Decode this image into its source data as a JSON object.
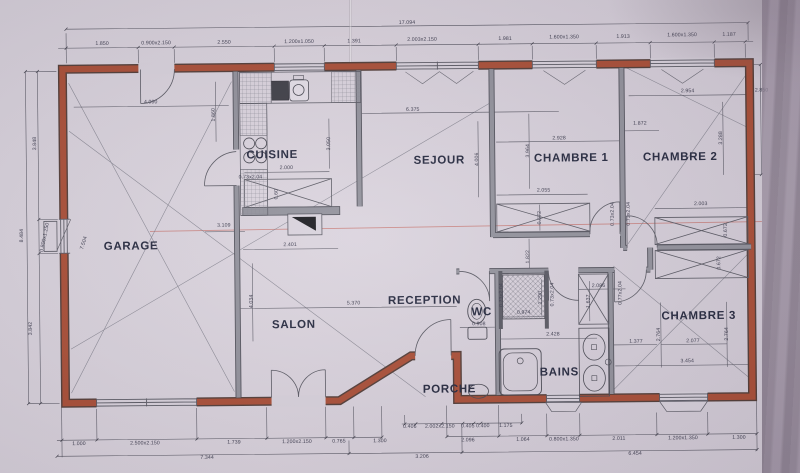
{
  "plan": {
    "overall_width_label": "17.094",
    "colors": {
      "paper": "#d8d2dc",
      "exterior_wall": "#a84a31",
      "wall_edge": "#4e3832",
      "interior_wall": "#8f8f99",
      "line": "#4c4c58",
      "label_text": "#20243a",
      "red_pen_line": "#c0554a"
    },
    "rooms": [
      {
        "label": "GARAGE",
        "x": 131,
        "y": 244
      },
      {
        "label": "CUISINE",
        "x": 273,
        "y": 154
      },
      {
        "label": "SEJOUR",
        "x": 440,
        "y": 161
      },
      {
        "label": "CHAMBRE 1",
        "x": 572,
        "y": 160
      },
      {
        "label": "CHAMBRE 2",
        "x": 681,
        "y": 160
      },
      {
        "label": "CHAMBRE 3",
        "x": 698,
        "y": 319
      },
      {
        "label": "SALON",
        "x": 293,
        "y": 324
      },
      {
        "label": "RECEPTION",
        "x": 424,
        "y": 301
      },
      {
        "label": "WC",
        "x": 481,
        "y": 313
      },
      {
        "label": "BAINS",
        "x": 558,
        "y": 374
      },
      {
        "label": "PORCHE",
        "x": 448,
        "y": 390
      }
    ],
    "dims": [
      {
        "text": "17.094",
        "x": 409,
        "y": 23,
        "rot": 0
      },
      {
        "text": "1.850",
        "x": 104,
        "y": 41,
        "rot": 0
      },
      {
        "text": "0.900x2.150",
        "x": 158,
        "y": 41,
        "rot": 0
      },
      {
        "text": "2.550",
        "x": 226,
        "y": 41,
        "rot": 0
      },
      {
        "text": "1.200x1.050",
        "x": 301,
        "y": 41,
        "rot": 0
      },
      {
        "text": "1.391",
        "x": 356,
        "y": 41,
        "rot": 0
      },
      {
        "text": "2.003x2.150",
        "x": 424,
        "y": 40,
        "rot": 0
      },
      {
        "text": "1.981",
        "x": 507,
        "y": 40,
        "rot": 0
      },
      {
        "text": "1.600x1.350",
        "x": 566,
        "y": 39,
        "rot": 0
      },
      {
        "text": "1.913",
        "x": 625,
        "y": 39,
        "rot": 0
      },
      {
        "text": "1.600x1.350",
        "x": 684,
        "y": 38,
        "rot": 0
      },
      {
        "text": "1.187",
        "x": 731,
        "y": 38,
        "rot": 0
      },
      {
        "text": "3.848",
        "x": 36,
        "y": 140,
        "rot": -90
      },
      {
        "text": "8.484",
        "x": 22,
        "y": 232,
        "rot": -90
      },
      {
        "text": "0.800x1.250",
        "x": 45,
        "y": 234,
        "rot": -78
      },
      {
        "text": "3.842",
        "x": 30,
        "y": 325,
        "rot": -90
      },
      {
        "text": "7.504",
        "x": 84,
        "y": 240,
        "rot": -72
      },
      {
        "text": "4.000",
        "x": 152,
        "y": 100,
        "rot": 0
      },
      {
        "text": "1.860",
        "x": 215,
        "y": 113,
        "rot": -90
      },
      {
        "text": "0.73x2.04",
        "x": 251,
        "y": 176,
        "rot": 0
      },
      {
        "text": "3.109",
        "x": 224,
        "y": 224,
        "rot": 0
      },
      {
        "text": "6.375",
        "x": 414,
        "y": 110,
        "rot": 0
      },
      {
        "text": "3.050",
        "x": 330,
        "y": 143,
        "rot": -90
      },
      {
        "text": "2.000",
        "x": 287,
        "y": 167,
        "rot": 0
      },
      {
        "text": "0.60",
        "x": 277,
        "y": 193,
        "rot": -90
      },
      {
        "text": "2.401",
        "x": 290,
        "y": 244,
        "rot": 0
      },
      {
        "text": "4.034",
        "x": 251,
        "y": 300,
        "rot": -90
      },
      {
        "text": "5.370",
        "x": 353,
        "y": 303,
        "rot": 0
      },
      {
        "text": "4.006",
        "x": 478,
        "y": 160,
        "rot": -90
      },
      {
        "text": "2.928",
        "x": 560,
        "y": 140,
        "rot": 0
      },
      {
        "text": "3.964",
        "x": 529,
        "y": 152,
        "rot": -90
      },
      {
        "text": "2.055",
        "x": 544,
        "y": 192,
        "rot": 0
      },
      {
        "text": "0.672",
        "x": 540,
        "y": 219,
        "rot": -90
      },
      {
        "text": "0.73x2.04",
        "x": 613,
        "y": 216,
        "rot": -90
      },
      {
        "text": "0.73x2.04",
        "x": 629,
        "y": 216,
        "rot": -90
      },
      {
        "text": "1.872",
        "x": 641,
        "y": 126,
        "rot": 0
      },
      {
        "text": "2.954",
        "x": 689,
        "y": 94,
        "rot": 0
      },
      {
        "text": "2.850",
        "x": 763,
        "y": 94,
        "rot": 0
      },
      {
        "text": "3.288",
        "x": 722,
        "y": 141,
        "rot": -90
      },
      {
        "text": "2.003",
        "x": 701,
        "y": 207,
        "rot": 0
      },
      {
        "text": "0.672",
        "x": 726,
        "y": 233,
        "rot": -90
      },
      {
        "text": "0.672",
        "x": 719,
        "y": 266,
        "rot": -90
      },
      {
        "text": "1.822",
        "x": 528,
        "y": 258,
        "rot": -90
      },
      {
        "text": "0.908",
        "x": 478,
        "y": 325,
        "rot": 0
      },
      {
        "text": "0.73x2.04",
        "x": 501,
        "y": 296,
        "rot": -90
      },
      {
        "text": "0.73x2.04",
        "x": 552,
        "y": 296,
        "rot": -90
      },
      {
        "text": "0.974",
        "x": 523,
        "y": 314,
        "rot": 0
      },
      {
        "text": "1.290",
        "x": 540,
        "y": 299,
        "rot": -90
      },
      {
        "text": "2.428",
        "x": 552,
        "y": 336,
        "rot": 0
      },
      {
        "text": "2.086",
        "x": 598,
        "y": 288,
        "rot": 0
      },
      {
        "text": "1.637",
        "x": 588,
        "y": 303,
        "rot": -90
      },
      {
        "text": "0.77x2.04",
        "x": 620,
        "y": 295,
        "rot": -90
      },
      {
        "text": "1.377",
        "x": 635,
        "y": 344,
        "rot": 0
      },
      {
        "text": "2.764",
        "x": 658,
        "y": 337,
        "rot": -90
      },
      {
        "text": "2.077",
        "x": 692,
        "y": 344,
        "rot": 0
      },
      {
        "text": "2.764",
        "x": 726,
        "y": 337,
        "rot": -90
      },
      {
        "text": "3.454",
        "x": 686,
        "y": 364,
        "rot": 0
      },
      {
        "text": "1.000",
        "x": 77,
        "y": 441,
        "rot": 0
      },
      {
        "text": "2.500x2.150",
        "x": 143,
        "y": 441,
        "rot": 0
      },
      {
        "text": "1.739",
        "x": 232,
        "y": 441,
        "rot": 0
      },
      {
        "text": "1.200x2.150",
        "x": 295,
        "y": 441,
        "rot": 0
      },
      {
        "text": "0.765",
        "x": 337,
        "y": 441,
        "rot": 0
      },
      {
        "text": "1.300",
        "x": 378,
        "y": 441,
        "rot": 0
      },
      {
        "text": "0.406",
        "x": 408,
        "y": 427,
        "rot": 0
      },
      {
        "text": "2.002x2.150",
        "x": 438,
        "y": 427,
        "rot": 0
      },
      {
        "text": "0.405",
        "x": 466,
        "y": 427,
        "rot": 0
      },
      {
        "text": "0.400",
        "x": 481,
        "y": 427,
        "rot": 0
      },
      {
        "text": "1.175",
        "x": 504,
        "y": 427,
        "rot": 0
      },
      {
        "text": "2.096",
        "x": 466,
        "y": 441,
        "rot": 0
      },
      {
        "text": "1.064",
        "x": 521,
        "y": 441,
        "rot": 0
      },
      {
        "text": "0.800x1.350",
        "x": 562,
        "y": 441,
        "rot": 0
      },
      {
        "text": "2.011",
        "x": 617,
        "y": 441,
        "rot": 0
      },
      {
        "text": "1.200x1.350",
        "x": 681,
        "y": 441,
        "rot": 0
      },
      {
        "text": "1.300",
        "x": 737,
        "y": 441,
        "rot": 0
      },
      {
        "text": "7.344",
        "x": 205,
        "y": 456,
        "rot": 0
      },
      {
        "text": "3.206",
        "x": 420,
        "y": 457,
        "rot": 0
      },
      {
        "text": "6.454",
        "x": 633,
        "y": 456,
        "rot": 0
      }
    ]
  }
}
